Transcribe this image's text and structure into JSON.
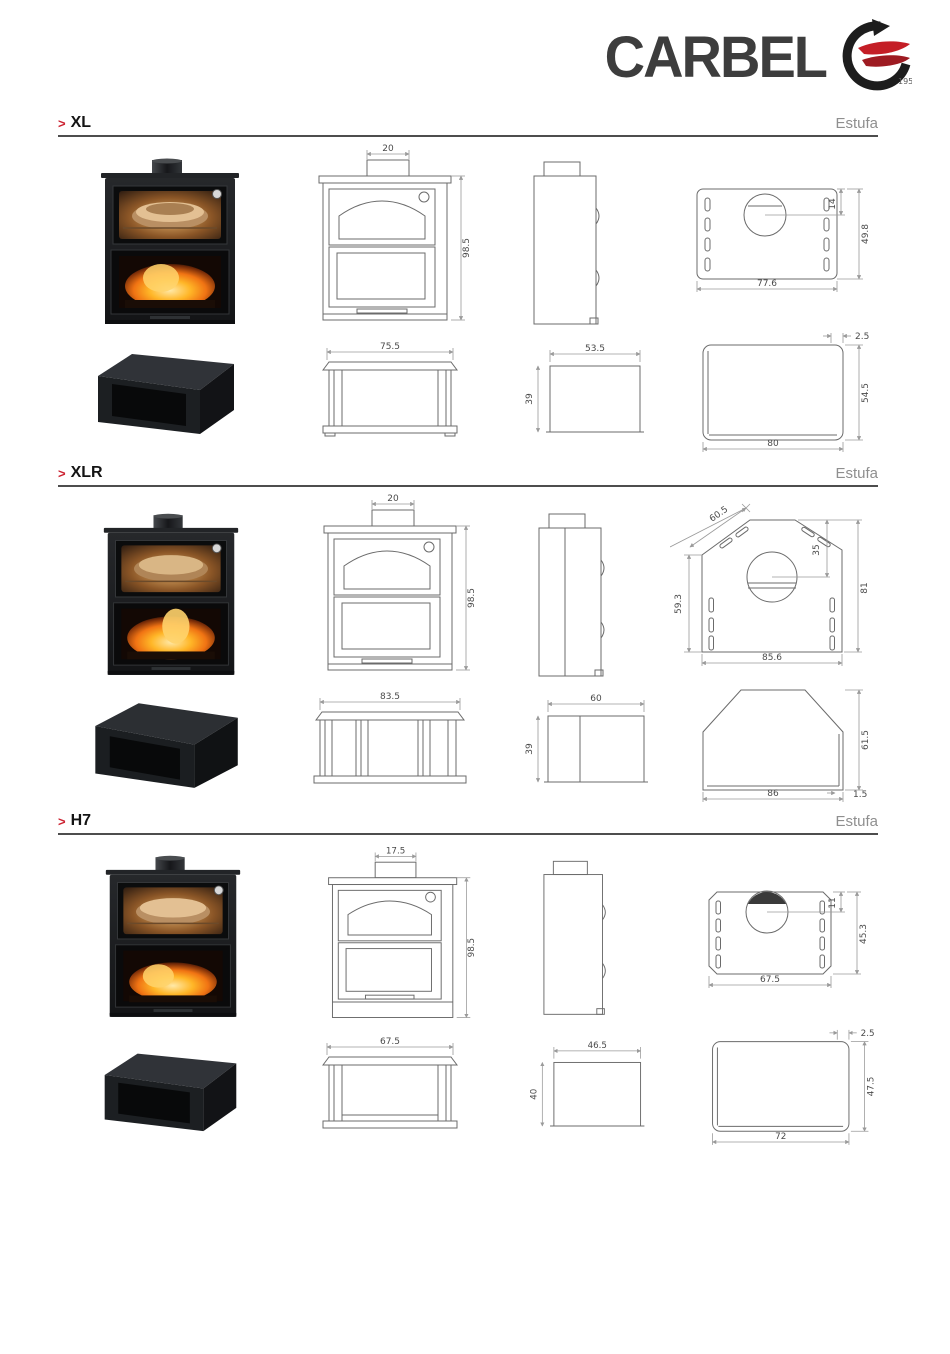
{
  "logo": {
    "brand": "CARBEL",
    "year": "1957"
  },
  "ui": {
    "section_bullet": ">"
  },
  "colors": {
    "accent_red": "#cc2130",
    "logo_gray": "#3d3d3d",
    "flame_red": "#c41e26",
    "rule_gray": "#4d4d4d",
    "estufa_gray": "#8f8f8f"
  },
  "sections": [
    {
      "name": "XL",
      "type_label": "Estufa",
      "front": {
        "pipe_width": "20",
        "height": "98.5"
      },
      "top_plate": {
        "flue_offset": "14",
        "depth": "49.8",
        "width": "77.6"
      },
      "base_front": {
        "width": "75.5"
      },
      "base_side": {
        "width": "53.5",
        "height": "39"
      },
      "base_top": {
        "width": "80",
        "depth": "54.5",
        "edge": "2.5"
      }
    },
    {
      "name": "XLR",
      "type_label": "Estufa",
      "front": {
        "pipe_width": "20",
        "height": "98.5"
      },
      "top_plate": {
        "diagonal": "60.5",
        "flue_offset": "35",
        "side_depth": "59.3",
        "total_depth": "81",
        "width": "85.6"
      },
      "base_front": {
        "width": "83.5"
      },
      "base_side": {
        "width": "60",
        "height": "39"
      },
      "base_top": {
        "width": "86",
        "depth": "61.5",
        "edge": "1.5"
      }
    },
    {
      "name": "H7",
      "type_label": "Estufa",
      "front": {
        "pipe_width": "17.5",
        "height": "98.5"
      },
      "top_plate": {
        "flue_offset": "11",
        "depth": "45.3",
        "width": "67.5"
      },
      "base_front": {
        "width": "67.5"
      },
      "base_side": {
        "width": "46.5",
        "height": "40"
      },
      "base_top": {
        "width": "72",
        "depth": "47.5",
        "edge": "2.5"
      }
    }
  ]
}
